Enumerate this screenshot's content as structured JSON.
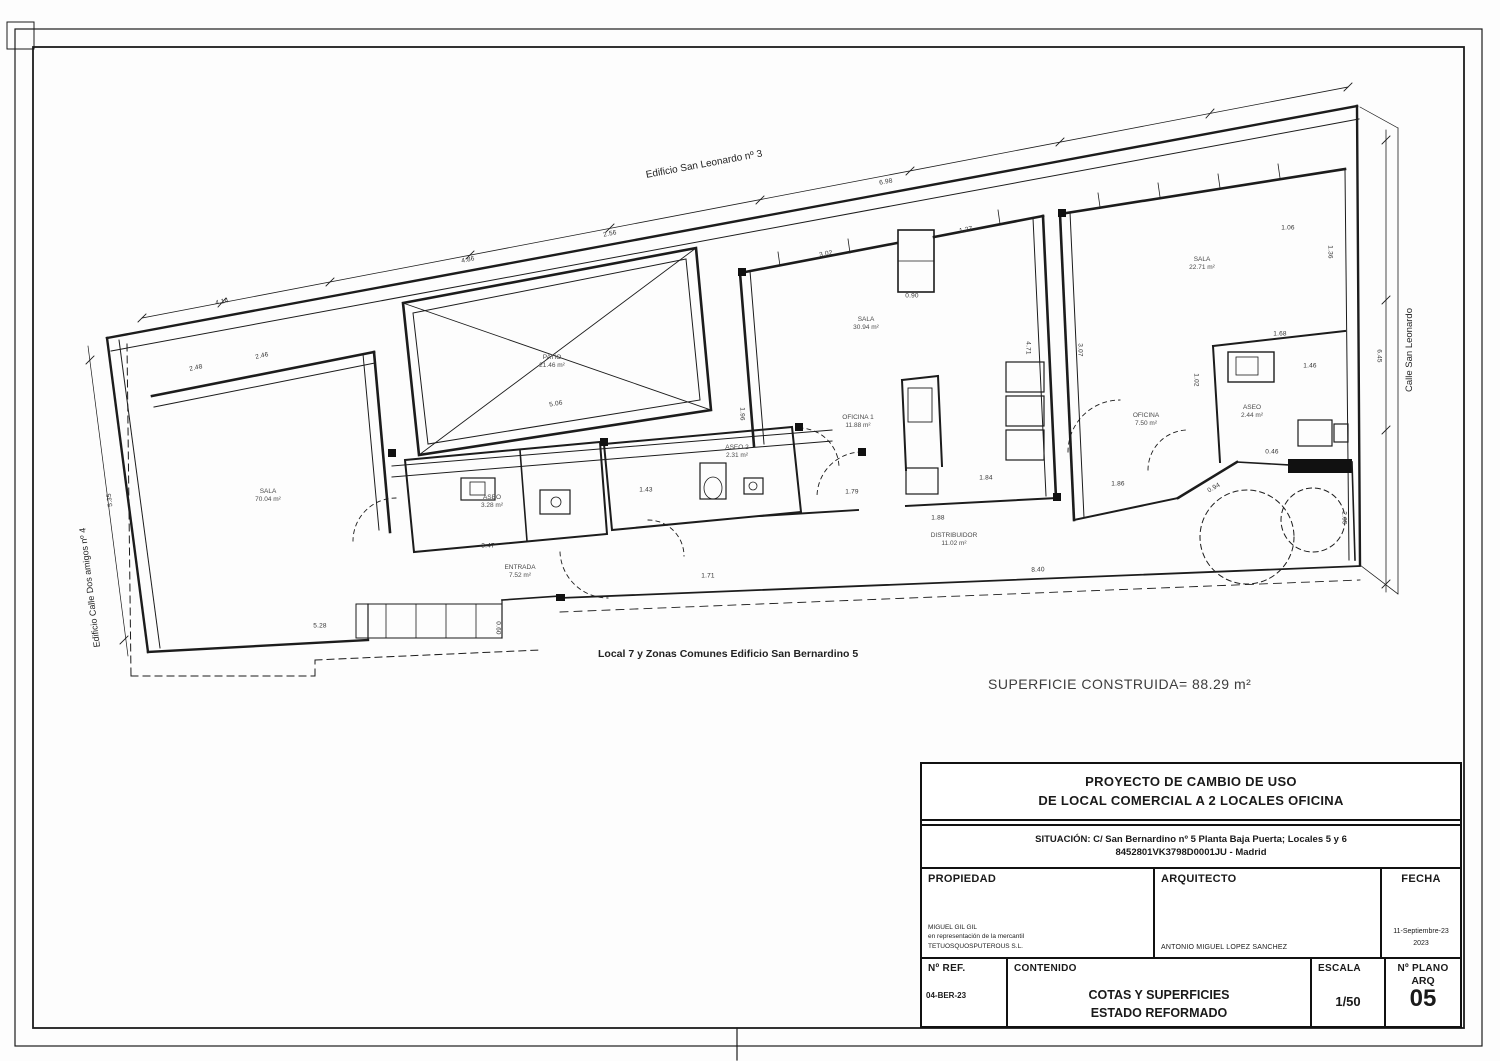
{
  "sheet": {
    "labels": {
      "top_building": "Edificio San Leonardo nº 3",
      "right_street": "Calle San Leonardo",
      "left_building": "Edificio Calle Dos amigos nº 4",
      "bottom_note": "Local 7 y Zonas Comunes Edificio San Bernardino 5",
      "superficie": "SUPERFICIE CONSTRUIDA= 88.29 m²"
    }
  },
  "rooms": [
    {
      "name": "SALA",
      "area": "70.04 m²"
    },
    {
      "name": "PATIO",
      "area": "21.46 m²"
    },
    {
      "name": "ASEO",
      "area": "3.28 m²"
    },
    {
      "name": "ENTRADA",
      "area": "7.52 m²"
    },
    {
      "name": "ASEO 2",
      "area": "2.31 m²"
    },
    {
      "name": "SALA",
      "area": "30.94 m²"
    },
    {
      "name": "OFICINA 1",
      "area": "11.88 m²"
    },
    {
      "name": "DISTRIBUIDOR",
      "area": "11.02 m²"
    },
    {
      "name": "SALA",
      "area": "22.71 m²"
    },
    {
      "name": "OFICINA",
      "area": "7.50 m²"
    },
    {
      "name": "ASEO",
      "area": "2.44 m²"
    }
  ],
  "dims": [
    {
      "v": "4.14"
    },
    {
      "v": "2.48"
    },
    {
      "v": "2.46"
    },
    {
      "v": "4.86"
    },
    {
      "v": "2.56"
    },
    {
      "v": "6.98"
    },
    {
      "v": "5.06"
    },
    {
      "v": "3.02"
    },
    {
      "v": "1.27"
    },
    {
      "v": "0.90"
    },
    {
      "v": "1.96"
    },
    {
      "v": "4.71"
    },
    {
      "v": "3.07"
    },
    {
      "v": "6.45"
    },
    {
      "v": "1.02"
    },
    {
      "v": "1.68"
    },
    {
      "v": "1.46"
    },
    {
      "v": "1.36"
    },
    {
      "v": "1.06"
    },
    {
      "v": "1.43"
    },
    {
      "v": "1.71"
    },
    {
      "v": "1.79"
    },
    {
      "v": "1.84"
    },
    {
      "v": "1.88"
    },
    {
      "v": "3.47"
    },
    {
      "v": "5.28"
    },
    {
      "v": "0.60"
    },
    {
      "v": "8.40"
    },
    {
      "v": "1.86"
    },
    {
      "v": "0.94"
    },
    {
      "v": "2.05"
    },
    {
      "v": "5.35"
    },
    {
      "v": "0.46"
    }
  ],
  "title_block": {
    "project_line1": "PROYECTO DE CAMBIO DE USO",
    "project_line2": "DE LOCAL COMERCIAL A 2 LOCALES OFICINA",
    "situacion_line1": "SITUACIÓN: C/ San Bernardino nº 5 Planta Baja Puerta; Locales 5 y 6",
    "situacion_line2": "8452801VK3798D0001JU  -  Madrid",
    "propiedad_label": "PROPIEDAD",
    "propiedad_line1": "MIGUEL GIL GIL",
    "propiedad_line2": "en representación de la mercantil",
    "propiedad_line3": "TETUOSQUOSPUTEROUS S.L.",
    "arquitecto_label": "ARQUITECTO",
    "arquitecto_name": "ANTONIO MIGUEL LOPEZ SANCHEZ",
    "fecha_label": "FECHA",
    "fecha_line1": "11-Septiembre-23",
    "fecha_line2": "2023",
    "ref_label": "Nº REF.",
    "ref_value": "04-BER-23",
    "contenido_label": "CONTENIDO",
    "contenido_line1": "COTAS Y SUPERFICIES",
    "contenido_line2": "ESTADO REFORMADO",
    "escala_label": "ESCALA",
    "escala_value": "1/50",
    "plano_label": "Nº PLANO",
    "plano_type": "ARQ",
    "plano_number": "05"
  }
}
